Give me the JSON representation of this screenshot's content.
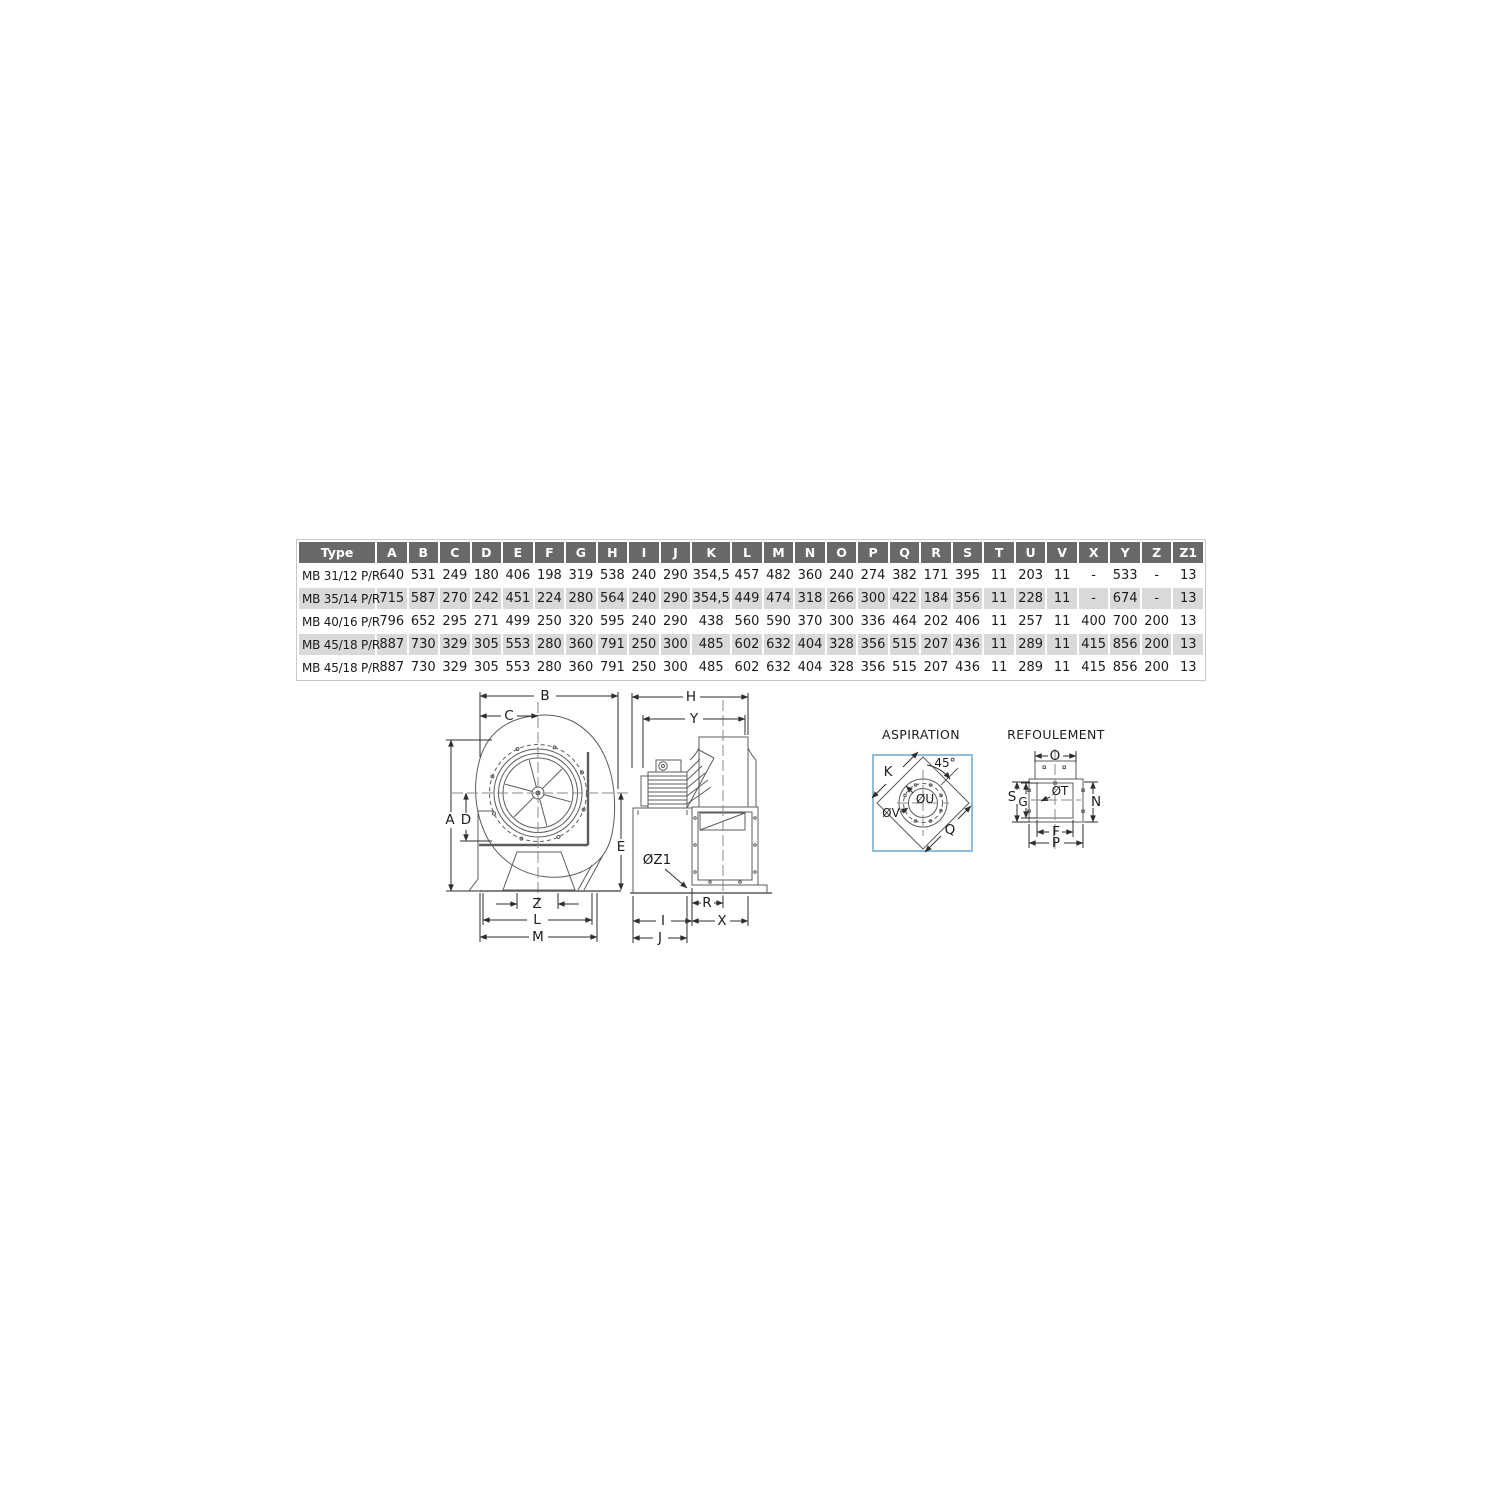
{
  "page": {
    "background": "#ffffff"
  },
  "colors": {
    "table_header_bg": "#696969",
    "table_row_alt": "#d9d9d9",
    "aspiration_box_border": "#8bbfe0",
    "drawing_line": "#5c5c5c"
  },
  "table": {
    "headers": [
      "Type",
      "A",
      "B",
      "C",
      "D",
      "E",
      "F",
      "G",
      "H",
      "I",
      "J",
      "K",
      "L",
      "M",
      "N",
      "O",
      "P",
      "Q",
      "R",
      "S",
      "T",
      "U",
      "V",
      "X",
      "Y",
      "Z",
      "Z1"
    ],
    "rows": [
      [
        "MB 31/12 P/R",
        "640",
        "531",
        "249",
        "180",
        "406",
        "198",
        "319",
        "538",
        "240",
        "290",
        "354,5",
        "457",
        "482",
        "360",
        "240",
        "274",
        "382",
        "171",
        "395",
        "11",
        "203",
        "11",
        "-",
        "533",
        "-",
        "13"
      ],
      [
        "MB 35/14 P/R",
        "715",
        "587",
        "270",
        "242",
        "451",
        "224",
        "280",
        "564",
        "240",
        "290",
        "354,5",
        "449",
        "474",
        "318",
        "266",
        "300",
        "422",
        "184",
        "356",
        "11",
        "228",
        "11",
        "-",
        "674",
        "-",
        "13"
      ],
      [
        "MB 40/16 P/R",
        "796",
        "652",
        "295",
        "271",
        "499",
        "250",
        "320",
        "595",
        "240",
        "290",
        "438",
        "560",
        "590",
        "370",
        "300",
        "336",
        "464",
        "202",
        "406",
        "11",
        "257",
        "11",
        "400",
        "700",
        "200",
        "13"
      ],
      [
        "MB 45/18 P/R",
        "887",
        "730",
        "329",
        "305",
        "553",
        "280",
        "360",
        "791",
        "250",
        "300",
        "485",
        "602",
        "632",
        "404",
        "328",
        "356",
        "515",
        "207",
        "436",
        "11",
        "289",
        "11",
        "415",
        "856",
        "200",
        "13"
      ],
      [
        "MB 45/18 P/R",
        "887",
        "730",
        "329",
        "305",
        "553",
        "280",
        "360",
        "791",
        "250",
        "300",
        "485",
        "602",
        "632",
        "404",
        "328",
        "356",
        "515",
        "207",
        "436",
        "11",
        "289",
        "11",
        "415",
        "856",
        "200",
        "13"
      ]
    ]
  },
  "drawings": {
    "front_view": {
      "labels": {
        "b": "B",
        "c": "C",
        "a": "A",
        "d": "D",
        "e": "E",
        "z": "Z",
        "l": "L",
        "m": "M"
      }
    },
    "side_view": {
      "labels": {
        "h": "H",
        "y": "Y",
        "r": "R",
        "i": "I",
        "x": "X",
        "j": "J"
      },
      "hole_label": "ØZ1"
    },
    "aspiration": {
      "title": "ASPIRATION",
      "labels": {
        "k": "K",
        "angle": "45°",
        "u": "ØU",
        "v": "ØV",
        "q": "Q"
      }
    },
    "refoulement": {
      "title": "REFOULEMENT",
      "labels": {
        "o": "O",
        "s": "S",
        "g": "G",
        "t": "ØT",
        "n": "N",
        "f": "F",
        "p": "P"
      }
    }
  }
}
